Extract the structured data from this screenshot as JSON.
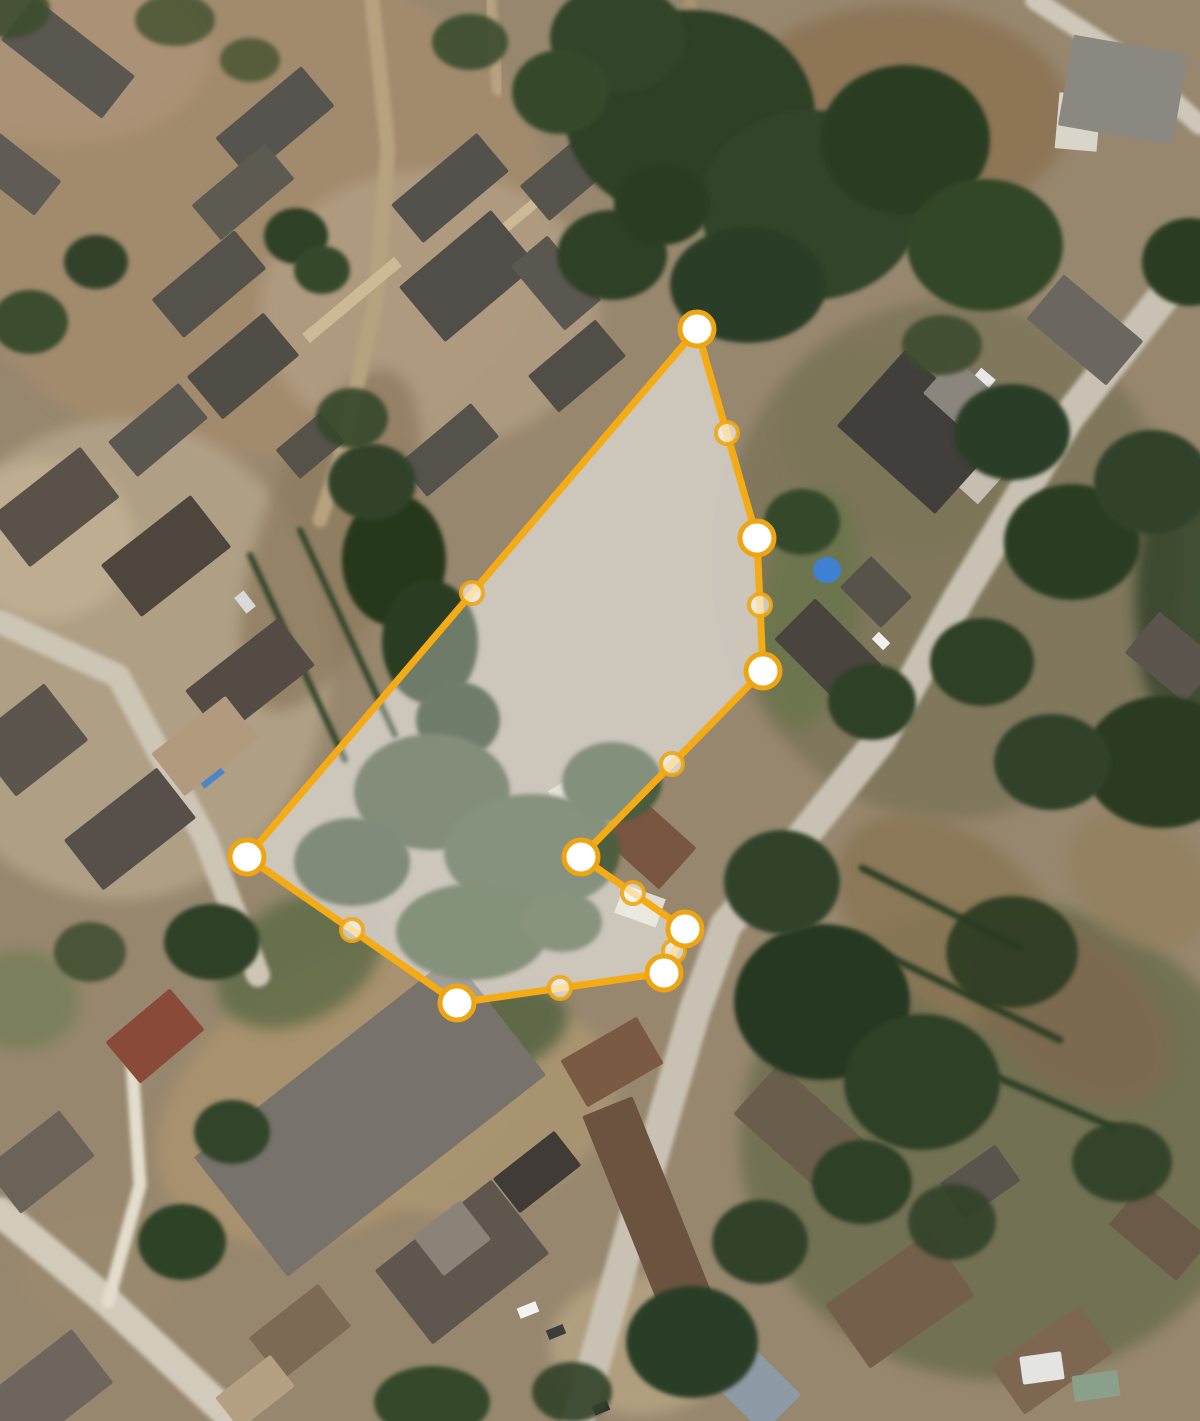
{
  "map": {
    "view": "satellite-aerial",
    "width": 1200,
    "height": 1421,
    "ground_color": "#97876e",
    "parcel_terrain_color": "#b6ad9e"
  },
  "parcel": {
    "stroke_color": "#f5ac14",
    "stroke_width": 7,
    "fill_color": "rgba(255,255,255,0.32)",
    "vertices": [
      [
        697,
        329
      ],
      [
        757,
        538
      ],
      [
        763,
        671
      ],
      [
        581,
        857
      ],
      [
        685,
        929
      ],
      [
        664,
        973
      ],
      [
        457,
        1003
      ],
      [
        247,
        857
      ]
    ],
    "midpoints": [
      [
        727,
        433
      ],
      [
        760,
        605
      ],
      [
        672,
        764
      ],
      [
        633,
        893
      ],
      [
        674,
        951
      ],
      [
        560,
        988
      ],
      [
        352,
        930
      ],
      [
        472,
        593
      ]
    ],
    "vertex_style": {
      "radius": 17,
      "fill": "#ffffff",
      "ring_color": "#efa512",
      "ring_width": 5
    },
    "midpoint_style": {
      "radius": 11,
      "fill": "rgba(255,255,255,0.62)",
      "ring_color": "rgba(239,165,18,0.9)",
      "ring_width": 4
    }
  },
  "scene": {
    "patches": [
      [
        250,
        210,
        300,
        250,
        0,
        "#a28a6d",
        1
      ],
      [
        60,
        55,
        150,
        90,
        0,
        "#ab9175",
        1
      ],
      [
        430,
        310,
        170,
        140,
        0,
        "#b5a287",
        0.7
      ],
      [
        120,
        660,
        210,
        240,
        0,
        "#b2a388",
        0.9
      ],
      [
        45,
        540,
        90,
        80,
        0,
        "#c2b193",
        0.8
      ],
      [
        900,
        115,
        170,
        110,
        0,
        "#8d7456",
        1
      ],
      [
        950,
        560,
        230,
        260,
        0,
        "#6e6b4f",
        0.55
      ],
      [
        890,
        450,
        120,
        90,
        40,
        "#7a7457",
        0.6
      ],
      [
        350,
        1090,
        210,
        130,
        -30,
        "#a8916e",
        1
      ],
      [
        480,
        1110,
        140,
        100,
        -20,
        "#aa9572",
        0.9
      ],
      [
        1000,
        1140,
        260,
        240,
        0,
        "#55603c",
        0.55
      ],
      [
        950,
        920,
        130,
        85,
        40,
        "#8a7757",
        0.9
      ],
      [
        1070,
        1010,
        120,
        75,
        40,
        "#7d6b4f",
        0.9
      ],
      [
        1140,
        880,
        80,
        60,
        40,
        "#93805f",
        0.8
      ],
      [
        330,
        540,
        70,
        180,
        20,
        "#8f7c61",
        0.8
      ],
      [
        300,
        960,
        90,
        60,
        -30,
        "#5c6a44",
        0.8
      ],
      [
        480,
        1035,
        90,
        45,
        -15,
        "#4e5e3c",
        0.8
      ],
      [
        810,
        610,
        50,
        120,
        8,
        "#66754a",
        0.7
      ],
      [
        640,
        1345,
        90,
        70,
        0,
        "#b7a584",
        0.8
      ],
      [
        100,
        1270,
        80,
        60,
        0,
        "#9b8a70",
        0.7
      ],
      [
        20,
        1000,
        60,
        50,
        0,
        "#6b7a50",
        0.6
      ],
      [
        1185,
        600,
        50,
        140,
        0,
        "#2f4126",
        0.8
      ]
    ],
    "roads": [
      {
        "pts": [
          [
            1200,
            250
          ],
          [
            1068,
            418
          ],
          [
            958,
            600
          ],
          [
            880,
            740
          ],
          [
            800,
            840
          ],
          [
            726,
            925
          ],
          [
            695,
            1010
          ],
          [
            660,
            1130
          ],
          [
            612,
            1300
          ],
          [
            578,
            1421
          ]
        ],
        "w": 32,
        "c": "#c9c2b4"
      },
      {
        "pts": [
          [
            1035,
            0
          ],
          [
            1130,
            62
          ],
          [
            1200,
            125
          ]
        ],
        "w": 20,
        "c": "#cfc8ba"
      },
      {
        "pts": [
          [
            372,
            0
          ],
          [
            388,
            150
          ],
          [
            376,
            300
          ],
          [
            342,
            452
          ],
          [
            320,
            520
          ]
        ],
        "w": 15,
        "c": "#b7a280"
      },
      {
        "pts": [
          [
            490,
            0
          ],
          [
            498,
            90
          ]
        ],
        "w": 12,
        "c": "#b7a280"
      },
      {
        "pts": [
          [
            0,
            622
          ],
          [
            118,
            676
          ],
          [
            205,
            838
          ],
          [
            258,
            975
          ]
        ],
        "w": 24,
        "c": "#cdc5b5"
      },
      {
        "pts": [
          [
            0,
            1212
          ],
          [
            108,
            1302
          ],
          [
            235,
            1421
          ]
        ],
        "w": 30,
        "c": "#d2cbbc"
      },
      {
        "pts": [
          [
            108,
            1302
          ],
          [
            140,
            1185
          ],
          [
            132,
            1062
          ]
        ],
        "w": 13,
        "c": "#e4ddcd"
      },
      {
        "pts": [
          [
            690,
            0
          ],
          [
            700,
            90
          ],
          [
            685,
            180
          ]
        ],
        "w": 12,
        "c": "#a9926f"
      }
    ],
    "hedges": [
      {
        "pts": [
          [
            862,
            868
          ],
          [
            1020,
            948
          ]
        ],
        "w": 7,
        "c": "#2e4126"
      },
      {
        "pts": [
          [
            880,
            952
          ],
          [
            1060,
            1040
          ]
        ],
        "w": 7,
        "c": "#2e4126"
      },
      {
        "pts": [
          [
            930,
            1048
          ],
          [
            1115,
            1128
          ]
        ],
        "w": 7,
        "c": "#2e4126"
      },
      {
        "pts": [
          [
            250,
            555
          ],
          [
            345,
            760
          ]
        ],
        "w": 6,
        "c": "#33452b"
      },
      {
        "pts": [
          [
            300,
            530
          ],
          [
            395,
            735
          ]
        ],
        "w": 6,
        "c": "#33452b"
      }
    ],
    "details": [
      [
        208,
        772,
        26,
        22,
        -38,
        "#4a86c8",
        "rect"
      ],
      [
        827,
        570,
        28,
        26,
        0,
        "#3f80d2",
        "ellipse"
      ],
      [
        590,
        792,
        72,
        44,
        -30,
        "#d8d2c4",
        "rect"
      ],
      [
        640,
        906,
        44,
        30,
        20,
        "#e2ddd0",
        "rect"
      ],
      [
        963,
        452,
        92,
        58,
        42,
        "#c6bfb1",
        "rect"
      ],
      [
        1078,
        122,
        42,
        56,
        5,
        "#dad5ca",
        "rect"
      ],
      [
        352,
        300,
        120,
        12,
        -40,
        "#cdb996",
        "rect"
      ],
      [
        505,
        228,
        100,
        10,
        -40,
        "#cdb996",
        "rect"
      ],
      [
        245,
        602,
        12,
        20,
        -38,
        "#d9d9d9",
        "rect"
      ],
      [
        985,
        378,
        19,
        11,
        40,
        "#e8e8e8",
        "rect"
      ],
      [
        881,
        641,
        16,
        10,
        45,
        "#f0f0f0",
        "rect"
      ],
      [
        318,
        1092,
        12,
        18,
        -38,
        "#ffffff",
        "rect"
      ],
      [
        528,
        1310,
        20,
        11,
        -22,
        "#f2f2f2",
        "rect"
      ],
      [
        556,
        1332,
        18,
        10,
        -22,
        "#3c3c3c",
        "rect"
      ],
      [
        601,
        1408,
        16,
        10,
        -22,
        "#2f2f2f",
        "rect"
      ]
    ],
    "buildings": [
      [
        275,
        122,
        112,
        52,
        -40,
        "#56544e"
      ],
      [
        243,
        192,
        96,
        46,
        -40,
        "#5d5a52"
      ],
      [
        209,
        284,
        108,
        50,
        -40,
        "#55524b"
      ],
      [
        243,
        366,
        100,
        56,
        -40,
        "#504d46"
      ],
      [
        158,
        430,
        92,
        46,
        -40,
        "#5a5750"
      ],
      [
        310,
        446,
        58,
        38,
        -40,
        "#565249"
      ],
      [
        450,
        188,
        112,
        50,
        -40,
        "#53514b"
      ],
      [
        572,
        172,
        98,
        46,
        -40,
        "#57544d"
      ],
      [
        468,
        276,
        120,
        72,
        -40,
        "#504e48"
      ],
      [
        556,
        283,
        48,
        84,
        -40,
        "#5a5750"
      ],
      [
        449,
        450,
        94,
        44,
        -40,
        "#55524b"
      ],
      [
        577,
        366,
        88,
        48,
        -40,
        "#514e47"
      ],
      [
        68,
        58,
        128,
        54,
        38,
        "#5a5650"
      ],
      [
        14,
        172,
        86,
        44,
        38,
        "#605c55"
      ],
      [
        55,
        507,
        114,
        64,
        -38,
        "#5a5249"
      ],
      [
        166,
        556,
        114,
        66,
        -38,
        "#4e463d"
      ],
      [
        250,
        678,
        118,
        60,
        -38,
        "#544c44"
      ],
      [
        205,
        746,
        94,
        54,
        -38,
        "#b29a7f"
      ],
      [
        130,
        829,
        118,
        64,
        -38,
        "#57504a"
      ],
      [
        30,
        740,
        92,
        72,
        -38,
        "#5b554d"
      ],
      [
        920,
        432,
        132,
        102,
        42,
        "#413e3b"
      ],
      [
        962,
        396,
        62,
        48,
        42,
        "#8b867d"
      ],
      [
        1085,
        330,
        104,
        58,
        40,
        "#6b6660"
      ],
      [
        1123,
        90,
        116,
        92,
        10,
        "#8b8781"
      ],
      [
        828,
        652,
        94,
        58,
        45,
        "#4a443e"
      ],
      [
        876,
        592,
        58,
        44,
        45,
        "#585349"
      ],
      [
        1172,
        657,
        78,
        54,
        40,
        "#5b554d"
      ],
      [
        648,
        842,
        80,
        56,
        42,
        "#78563f"
      ],
      [
        505,
        906,
        112,
        54,
        -38,
        "#8a6b51"
      ],
      [
        155,
        1036,
        84,
        54,
        -40,
        "#8a4a3a"
      ],
      [
        370,
        1116,
        328,
        152,
        -38,
        "#77726b"
      ],
      [
        40,
        1162,
        94,
        58,
        -38,
        "#6b6258"
      ],
      [
        46,
        1392,
        118,
        68,
        -38,
        "#6e665c"
      ],
      [
        300,
        1332,
        88,
        54,
        -38,
        "#7d6a55"
      ],
      [
        255,
        1392,
        70,
        40,
        -38,
        "#b5a083"
      ],
      [
        650,
        1212,
        54,
        228,
        -22,
        "#6b5340"
      ],
      [
        462,
        1262,
        148,
        94,
        -38,
        "#5f574d"
      ],
      [
        452,
        1238,
        60,
        50,
        -38,
        "#8b8378"
      ],
      [
        537,
        1172,
        78,
        44,
        -38,
        "#403b36"
      ],
      [
        612,
        1062,
        88,
        54,
        -30,
        "#7a5a42"
      ],
      [
        800,
        1128,
        118,
        68,
        42,
        "#6b5d4b"
      ],
      [
        900,
        1300,
        128,
        78,
        -35,
        "#74604a"
      ],
      [
        1052,
        1360,
        108,
        58,
        -35,
        "#7d6750"
      ],
      [
        1160,
        1232,
        88,
        54,
        40,
        "#6b5a48"
      ],
      [
        980,
        1182,
        68,
        44,
        -35,
        "#59544c"
      ],
      [
        760,
        1392,
        62,
        54,
        45,
        "#8e9aa6"
      ],
      [
        1042,
        1368,
        42,
        28,
        -8,
        "#e4e4e2"
      ],
      [
        1096,
        1386,
        46,
        26,
        -8,
        "#8aa08a"
      ]
    ],
    "trees": [
      [
        690,
        115,
        125,
        105,
        "#2e4026",
        1
      ],
      [
        810,
        205,
        110,
        95,
        "#31452a",
        1
      ],
      [
        905,
        140,
        85,
        75,
        "#2b3d24",
        1
      ],
      [
        985,
        245,
        78,
        66,
        "#334727",
        1
      ],
      [
        618,
        38,
        68,
        55,
        "#31452a",
        1
      ],
      [
        748,
        285,
        78,
        58,
        "#2c3e25",
        1
      ],
      [
        560,
        92,
        48,
        42,
        "#35492c",
        1
      ],
      [
        612,
        255,
        55,
        45,
        "#2f4127",
        1
      ],
      [
        662,
        205,
        48,
        40,
        "#2b3d24",
        1
      ],
      [
        296,
        236,
        32,
        28,
        "#2f4128",
        1
      ],
      [
        322,
        270,
        28,
        24,
        "#36482b",
        1
      ],
      [
        30,
        322,
        38,
        32,
        "#3a4d2e",
        1
      ],
      [
        96,
        262,
        32,
        27,
        "#31432a",
        1
      ],
      [
        470,
        42,
        38,
        28,
        "#3a4d2e",
        0.9
      ],
      [
        175,
        20,
        40,
        26,
        "#41512f",
        0.8
      ],
      [
        394,
        560,
        52,
        66,
        "#26371f",
        1
      ],
      [
        430,
        642,
        48,
        62,
        "#2b3d24",
        1
      ],
      [
        372,
        482,
        44,
        38,
        "#31432a",
        1
      ],
      [
        458,
        720,
        42,
        38,
        "#2e4026",
        1
      ],
      [
        352,
        418,
        36,
        30,
        "#34462b",
        0.9
      ],
      [
        432,
        792,
        78,
        58,
        "#48593a",
        1
      ],
      [
        532,
        852,
        88,
        58,
        "#4e5f40",
        1
      ],
      [
        612,
        782,
        50,
        40,
        "#4a5b3c",
        1
      ],
      [
        352,
        862,
        58,
        44,
        "#44553a",
        1
      ],
      [
        472,
        932,
        76,
        48,
        "#4c5d3e",
        1
      ],
      [
        562,
        922,
        40,
        30,
        "#516242",
        1
      ],
      [
        1012,
        432,
        58,
        48,
        "#2c3e25",
        1
      ],
      [
        1072,
        542,
        68,
        58,
        "#2a3c23",
        1
      ],
      [
        1152,
        482,
        58,
        52,
        "#31432a",
        1
      ],
      [
        982,
        662,
        52,
        44,
        "#2e4026",
        1
      ],
      [
        1162,
        762,
        78,
        66,
        "#293b22",
        1
      ],
      [
        1052,
        762,
        58,
        48,
        "#31432a",
        1
      ],
      [
        802,
        522,
        38,
        33,
        "#35482b",
        1
      ],
      [
        872,
        702,
        44,
        38,
        "#2d3f26",
        1
      ],
      [
        942,
        345,
        40,
        30,
        "#3c4c2d",
        0.9
      ],
      [
        1190,
        262,
        48,
        44,
        "#2b3d24",
        1
      ],
      [
        822,
        1002,
        88,
        78,
        "#273921",
        1
      ],
      [
        922,
        1082,
        78,
        68,
        "#2d3f26",
        1
      ],
      [
        782,
        882,
        58,
        52,
        "#31432a",
        1
      ],
      [
        1012,
        952,
        66,
        56,
        "#293b22",
        0.9
      ],
      [
        862,
        1182,
        50,
        42,
        "#2f4127",
        1
      ],
      [
        952,
        1222,
        44,
        38,
        "#31432a",
        0.9
      ],
      [
        1122,
        1162,
        50,
        40,
        "#2d3f26",
        0.9
      ],
      [
        692,
        1342,
        66,
        56,
        "#2c3e25",
        1
      ],
      [
        760,
        1242,
        48,
        42,
        "#31432a",
        1
      ],
      [
        432,
        1402,
        58,
        36,
        "#35482b",
        1
      ],
      [
        182,
        1242,
        44,
        38,
        "#2f4227",
        1
      ],
      [
        232,
        1132,
        38,
        32,
        "#31442a",
        1
      ],
      [
        212,
        942,
        48,
        38,
        "#2d3f26",
        1
      ],
      [
        90,
        952,
        36,
        30,
        "#37492c",
        0.8
      ],
      [
        572,
        1392,
        40,
        30,
        "#31432a",
        0.9
      ],
      [
        10,
        10,
        40,
        28,
        "#3c4e2f",
        0.9
      ],
      [
        250,
        60,
        30,
        22,
        "#44532f",
        0.8
      ]
    ]
  }
}
